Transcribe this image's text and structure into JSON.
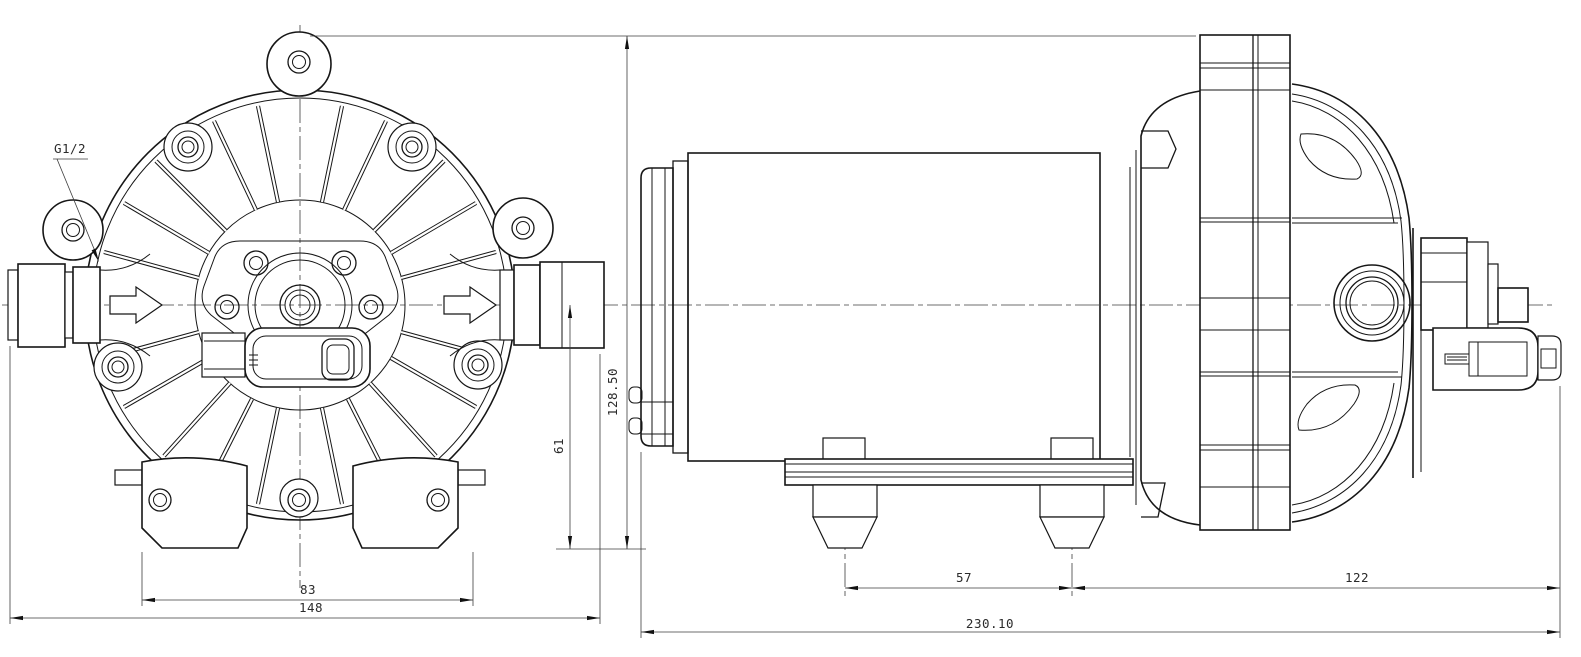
{
  "drawing": {
    "background": "#ffffff",
    "line_color": "#161616",
    "dim_color": "#3d3d3d",
    "dims": {
      "port_thread": "G1/2",
      "front_foot_width": "83",
      "front_overall_width": "148",
      "front_center_to_base": "61",
      "front_overall_height": "128.50",
      "side_foot_spacing": "57",
      "side_foot_to_front_face": "122",
      "side_overall_length": "230.10"
    }
  }
}
